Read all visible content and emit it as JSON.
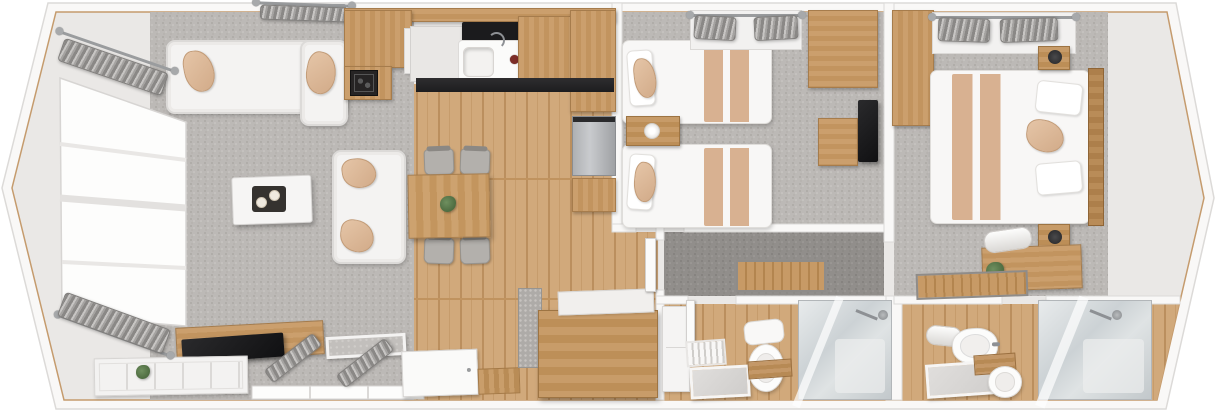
{
  "scene": "lodge-floorplan-3d-top-view",
  "palette": {
    "background": "#ffffff",
    "wall": "#f9f8f7",
    "wall_edge": "#dcdad8",
    "trim_wood": "#c59b6d",
    "floor_vinyl": "#eae8e6",
    "carpet_grey": "#bcb9b6",
    "carpet_dark": "#918e8b",
    "wood_floor": "#d1a97b",
    "wood_furniture": "#c79e6e",
    "sofa_white": "#f4f3f2",
    "cushion_tan": "#d8b191",
    "tv_black": "#1b1b1d",
    "chrome": "#8d9094",
    "glass_shower": "#ccd2d5"
  },
  "rooms": [
    {
      "id": "lounge",
      "name": "lounge-living-area",
      "floor": "grey-carpet"
    },
    {
      "id": "kitchen-diner",
      "name": "kitchen-dining-area",
      "floor": "oak-laminate"
    },
    {
      "id": "twin-bedroom",
      "name": "twin-bedroom",
      "floor": "grey-carpet"
    },
    {
      "id": "hallway",
      "name": "hallway",
      "floor": "dark-carpet"
    },
    {
      "id": "shower-room",
      "name": "family-shower-room",
      "floor": "oak-laminate"
    },
    {
      "id": "master-bedroom",
      "name": "master-bedroom",
      "floor": "grey-carpet"
    },
    {
      "id": "ensuite",
      "name": "ensuite-shower-room",
      "floor": "oak-laminate"
    }
  ],
  "furniture": [
    {
      "n": "kitchen-vent-rack",
      "t": "vent",
      "x": 288,
      "y": 4,
      "w": 58,
      "h": 16
    },
    {
      "n": "lounge-top-curtain-rod",
      "t": "rod",
      "x": 256,
      "y": 3,
      "w": 96,
      "h": 3,
      "r": 2
    },
    {
      "n": "lounge-top-curtain",
      "t": "curtain",
      "x": 260,
      "y": 6,
      "w": 88,
      "h": 15,
      "r": 2
    },
    {
      "n": "corner-sofa-main",
      "t": "sofa",
      "x": 166,
      "y": 40,
      "w": 182,
      "h": 74
    },
    {
      "n": "corner-sofa-chaise",
      "t": "sofa",
      "x": 300,
      "y": 40,
      "w": 48,
      "h": 86
    },
    {
      "n": "sofa-cushion-left",
      "t": "cushion",
      "x": 184,
      "y": 50,
      "w": 30,
      "h": 42,
      "r": -10
    },
    {
      "n": "sofa-cushion-right",
      "t": "cushion",
      "x": 306,
      "y": 52,
      "w": 30,
      "h": 42,
      "r": 12
    },
    {
      "n": "two-seat-sofa",
      "t": "sofa",
      "x": 332,
      "y": 150,
      "w": 74,
      "h": 114
    },
    {
      "n": "two-seat-cushion-top",
      "t": "cushion",
      "x": 342,
      "y": 158,
      "w": 34,
      "h": 30,
      "r": -8
    },
    {
      "n": "two-seat-cushion-bottom",
      "t": "cushion",
      "x": 340,
      "y": 220,
      "w": 34,
      "h": 32,
      "r": 8
    },
    {
      "n": "coffee-table",
      "t": "tablew",
      "x": 232,
      "y": 176,
      "w": 80,
      "h": 48,
      "r": -2
    },
    {
      "n": "coffee-table-tray",
      "t": "tray",
      "x": 252,
      "y": 186,
      "w": 34,
      "h": 26
    },
    {
      "n": "tv-cabinet",
      "t": "wood",
      "x": 176,
      "y": 324,
      "w": 148,
      "h": 34,
      "r": -3
    },
    {
      "n": "television",
      "t": "tv",
      "x": 182,
      "y": 336,
      "w": 102,
      "h": 24,
      "r": -4
    },
    {
      "n": "lounge-sideboard",
      "t": "sideboard",
      "x": 94,
      "y": 357,
      "w": 154,
      "h": 38,
      "r": -1
    },
    {
      "n": "sideboard-plant",
      "t": "plant",
      "x": 136,
      "y": 365,
      "w": 14,
      "h": 14
    },
    {
      "n": "window-ottoman",
      "t": "ottoman",
      "x": 326,
      "y": 335,
      "w": 80,
      "h": 22,
      "r": -3
    },
    {
      "n": "lounge-window-curtain-left",
      "t": "curtain",
      "x": 262,
      "y": 350,
      "w": 62,
      "h": 16,
      "r": -38
    },
    {
      "n": "lounge-window-curtain-right",
      "t": "curtain",
      "x": 334,
      "y": 355,
      "w": 62,
      "h": 16,
      "r": -38
    },
    {
      "n": "bay-curtain-rod-top",
      "t": "rod",
      "x": 56,
      "y": 50,
      "w": 122,
      "h": 3,
      "r": 19
    },
    {
      "n": "bay-curtain-top",
      "t": "curtain",
      "x": 58,
      "y": 55,
      "w": 110,
      "h": 24,
      "r": 19
    },
    {
      "n": "bay-curtain-rod-bottom",
      "t": "rod",
      "x": 54,
      "y": 334,
      "w": 120,
      "h": 3,
      "r": 20
    },
    {
      "n": "bay-curtain-bottom",
      "t": "curtain",
      "x": 58,
      "y": 310,
      "w": 112,
      "h": 26,
      "r": 20
    },
    {
      "n": "kitchen-wall-cabinet-band",
      "t": "wood",
      "x": 344,
      "y": 8,
      "w": 272,
      "h": 14
    },
    {
      "n": "kitchen-corner-cabinet",
      "t": "woodv",
      "x": 344,
      "y": 10,
      "w": 68,
      "h": 58
    },
    {
      "n": "kitchen-open-shelf",
      "t": "shelfw",
      "x": 404,
      "y": 28,
      "w": 30,
      "h": 46
    },
    {
      "n": "kitchen-worktop",
      "t": "worktop",
      "x": 410,
      "y": 26,
      "w": 60,
      "h": 56
    },
    {
      "n": "kitchen-hob",
      "t": "hob",
      "x": 462,
      "y": 22,
      "w": 58,
      "h": 22
    },
    {
      "n": "kitchen-sink",
      "t": "sink",
      "x": 458,
      "y": 40,
      "w": 74,
      "h": 42
    },
    {
      "n": "sink-red-knob",
      "t": "knob",
      "x": 510,
      "y": 55,
      "w": 9,
      "h": 9
    },
    {
      "n": "kitchen-drainer",
      "t": "drainer",
      "x": 528,
      "y": 46,
      "w": 40,
      "h": 16
    },
    {
      "n": "kitchen-cabinet-right",
      "t": "woodv",
      "x": 518,
      "y": 16,
      "w": 56,
      "h": 66
    },
    {
      "n": "kitchen-tall-larder",
      "t": "woodv",
      "x": 570,
      "y": 10,
      "w": 46,
      "h": 102
    },
    {
      "n": "kitchen-lower-units",
      "t": "darkrun",
      "x": 416,
      "y": 78,
      "w": 198,
      "h": 14
    },
    {
      "n": "stove-unit-cabinet",
      "t": "woodv",
      "x": 344,
      "y": 66,
      "w": 48,
      "h": 34
    },
    {
      "n": "log-burner-stove",
      "t": "stove",
      "x": 350,
      "y": 70,
      "w": 28,
      "h": 26
    },
    {
      "n": "fridge-freezer",
      "t": "fridge",
      "x": 572,
      "y": 116,
      "w": 44,
      "h": 60
    },
    {
      "n": "kitchen-base-unit",
      "t": "woodv",
      "x": 572,
      "y": 178,
      "w": 44,
      "h": 34
    },
    {
      "n": "dining-chair-1",
      "t": "chair",
      "x": 424,
      "y": 149,
      "w": 30,
      "h": 26,
      "r": -2
    },
    {
      "n": "dining-chair-2",
      "t": "chair",
      "x": 460,
      "y": 149,
      "w": 30,
      "h": 26,
      "r": 2
    },
    {
      "n": "dining-chair-3",
      "t": "chair",
      "x": 424,
      "y": 238,
      "w": 30,
      "h": 26,
      "r": 2
    },
    {
      "n": "dining-chair-4",
      "t": "chair",
      "x": 460,
      "y": 238,
      "w": 30,
      "h": 26,
      "r": -2
    },
    {
      "n": "dining-table",
      "t": "dtable",
      "x": 408,
      "y": 174,
      "w": 82,
      "h": 64,
      "r": -1
    },
    {
      "n": "dining-centerpiece",
      "t": "plant",
      "x": 440,
      "y": 196,
      "w": 16,
      "h": 16
    },
    {
      "n": "front-door",
      "t": "door",
      "x": 402,
      "y": 350,
      "w": 76,
      "h": 46,
      "r": -2
    },
    {
      "n": "door-mat",
      "t": "mat",
      "x": 478,
      "y": 368,
      "w": 42,
      "h": 26,
      "r": -2
    },
    {
      "n": "bench-side-cushion",
      "t": "benchside",
      "x": 518,
      "y": 288,
      "w": 24,
      "h": 80
    },
    {
      "n": "storage-bench",
      "t": "bench",
      "x": 538,
      "y": 310,
      "w": 120,
      "h": 88
    },
    {
      "n": "storage-bench-lid",
      "t": "shelfw",
      "x": 558,
      "y": 290,
      "w": 96,
      "h": 24,
      "r": -2
    },
    {
      "n": "twin-bed-1",
      "t": "bed",
      "x": 622,
      "y": 40,
      "w": 150,
      "h": 84
    },
    {
      "n": "twin-bed-1-runner",
      "t": "runner",
      "x": 704,
      "y": 44,
      "w": 50,
      "h": 78
    },
    {
      "n": "twin-bed-1-pillow",
      "t": "pillow",
      "x": 628,
      "y": 50,
      "w": 26,
      "h": 56,
      "r": -4
    },
    {
      "n": "twin-bed-1-cushion",
      "t": "cushion",
      "x": 634,
      "y": 58,
      "w": 22,
      "h": 40,
      "r": -6
    },
    {
      "n": "twin-bed-2",
      "t": "bed",
      "x": 622,
      "y": 144,
      "w": 150,
      "h": 84
    },
    {
      "n": "twin-bed-2-runner",
      "t": "runner",
      "x": 704,
      "y": 148,
      "w": 50,
      "h": 78
    },
    {
      "n": "twin-bed-2-pillow",
      "t": "pillow",
      "x": 628,
      "y": 154,
      "w": 26,
      "h": 56,
      "r": 4
    },
    {
      "n": "twin-bed-2-cushion",
      "t": "cushion",
      "x": 634,
      "y": 162,
      "w": 22,
      "h": 40,
      "r": 6
    },
    {
      "n": "twin-nightstand",
      "t": "nightstand",
      "x": 626,
      "y": 116,
      "w": 54,
      "h": 30
    },
    {
      "n": "twin-nightstand-lamp",
      "t": "lamp",
      "x": 644,
      "y": 123,
      "w": 16,
      "h": 16
    },
    {
      "n": "twin-window-pelmet",
      "t": "rail",
      "x": 690,
      "y": 10,
      "w": 112,
      "h": 40
    },
    {
      "n": "twin-curtain-rod",
      "t": "rod",
      "x": 690,
      "y": 14,
      "w": 112,
      "h": 3
    },
    {
      "n": "twin-curtain-left",
      "t": "curtain",
      "x": 694,
      "y": 16,
      "w": 42,
      "h": 24,
      "r": 3
    },
    {
      "n": "twin-curtain-right",
      "t": "curtain",
      "x": 754,
      "y": 16,
      "w": 44,
      "h": 24,
      "r": -3
    },
    {
      "n": "twin-overhead-locker",
      "t": "wood",
      "x": 808,
      "y": 10,
      "w": 70,
      "h": 78
    },
    {
      "n": "twin-dressing-table",
      "t": "wood",
      "x": 818,
      "y": 118,
      "w": 40,
      "h": 48
    },
    {
      "n": "twin-wall-tv",
      "t": "tv",
      "x": 858,
      "y": 100,
      "w": 20,
      "h": 62
    },
    {
      "n": "hallway-runner-rug",
      "t": "rugslat",
      "x": 736,
      "y": 260,
      "w": 90,
      "h": 32
    },
    {
      "n": "hallway-door",
      "t": "doorleaf",
      "x": 645,
      "y": 238,
      "w": 11,
      "h": 54
    },
    {
      "n": "bathroom-tall-cupboard",
      "t": "cabw",
      "x": 662,
      "y": 306,
      "w": 28,
      "h": 86
    },
    {
      "n": "bathroom-door",
      "t": "doorleaf",
      "x": 686,
      "y": 300,
      "w": 9,
      "h": 46
    },
    {
      "n": "bathroom-towel-rail",
      "t": "towelrail",
      "x": 686,
      "y": 340,
      "w": 40,
      "h": 26,
      "r": -4
    },
    {
      "n": "bathroom-vanity-mirror",
      "t": "mirror",
      "x": 690,
      "y": 366,
      "w": 60,
      "h": 32,
      "r": -3
    },
    {
      "n": "bathroom-toilet-cistern",
      "t": "cistern",
      "x": 744,
      "y": 320,
      "w": 40,
      "h": 24,
      "r": -6
    },
    {
      "n": "bathroom-toilet",
      "t": "toilet",
      "x": 748,
      "y": 344,
      "w": 36,
      "h": 48
    },
    {
      "n": "bathroom-caddy",
      "t": "caddy",
      "x": 748,
      "y": 360,
      "w": 44,
      "h": 18,
      "r": -4
    },
    {
      "n": "bathroom-shower",
      "t": "shower",
      "x": 798,
      "y": 300,
      "w": 94,
      "h": 100
    },
    {
      "n": "bathroom-shower-head",
      "t": "showerarm",
      "x": 856,
      "y": 302,
      "w": 32,
      "h": 18
    },
    {
      "n": "master-vanity-unit",
      "t": "woodv",
      "x": 892,
      "y": 10,
      "w": 42,
      "h": 116
    },
    {
      "n": "master-wardrobe",
      "t": "rail",
      "x": 932,
      "y": 12,
      "w": 144,
      "h": 42
    },
    {
      "n": "master-wardrobe-rail",
      "t": "rod",
      "x": 932,
      "y": 16,
      "w": 144,
      "h": 3
    },
    {
      "n": "master-hanging-clothes-left",
      "t": "curtain",
      "x": 938,
      "y": 18,
      "w": 52,
      "h": 24,
      "r": 2
    },
    {
      "n": "master-hanging-clothes-right",
      "t": "curtain",
      "x": 1000,
      "y": 18,
      "w": 58,
      "h": 24,
      "r": -2
    },
    {
      "n": "master-double-bed",
      "t": "bed",
      "x": 930,
      "y": 70,
      "w": 160,
      "h": 154
    },
    {
      "n": "master-bed-runner",
      "t": "runner",
      "x": 952,
      "y": 74,
      "w": 54,
      "h": 146
    },
    {
      "n": "master-headboard",
      "t": "headboard",
      "x": 1088,
      "y": 68,
      "w": 16,
      "h": 158
    },
    {
      "n": "master-pillow-top",
      "t": "pillow",
      "x": 1036,
      "y": 82,
      "w": 46,
      "h": 32,
      "r": 6
    },
    {
      "n": "master-pillow-bottom",
      "t": "pillow",
      "x": 1036,
      "y": 162,
      "w": 46,
      "h": 32,
      "r": -5
    },
    {
      "n": "master-scatter-cushion",
      "t": "cushion",
      "x": 1026,
      "y": 120,
      "w": 38,
      "h": 32,
      "r": 8
    },
    {
      "n": "master-nightstand-top",
      "t": "nightstand",
      "x": 1038,
      "y": 46,
      "w": 32,
      "h": 24
    },
    {
      "n": "master-lamp-top",
      "t": "lampdark",
      "x": 1048,
      "y": 50,
      "w": 14,
      "h": 14
    },
    {
      "n": "master-nightstand-bottom",
      "t": "nightstand",
      "x": 1038,
      "y": 224,
      "w": 32,
      "h": 26
    },
    {
      "n": "master-lamp-bottom",
      "t": "lampdark",
      "x": 1048,
      "y": 230,
      "w": 14,
      "h": 14
    },
    {
      "n": "master-dresser",
      "t": "wood",
      "x": 982,
      "y": 246,
      "w": 100,
      "h": 44,
      "r": -2
    },
    {
      "n": "master-towel-roll",
      "t": "towelroll",
      "x": 984,
      "y": 229,
      "w": 48,
      "h": 22,
      "r": -8
    },
    {
      "n": "master-dresser-plant",
      "t": "plant",
      "x": 986,
      "y": 262,
      "w": 18,
      "h": 18
    },
    {
      "n": "master-runner-rug",
      "t": "rugslat",
      "x": 916,
      "y": 272,
      "w": 112,
      "h": 26,
      "r": -2
    },
    {
      "n": "ensuite-door",
      "t": "doorleaf",
      "x": 1040,
      "y": 300,
      "w": 8,
      "h": 44
    },
    {
      "n": "ensuite-towel-roll",
      "t": "towelroll",
      "x": 926,
      "y": 326,
      "w": 36,
      "h": 20,
      "r": 6
    },
    {
      "n": "ensuite-basin",
      "t": "basin",
      "x": 952,
      "y": 328,
      "w": 46,
      "h": 36,
      "r": -2
    },
    {
      "n": "ensuite-mirror",
      "t": "mirror",
      "x": 926,
      "y": 362,
      "w": 82,
      "h": 34,
      "r": -4
    },
    {
      "n": "ensuite-caddy",
      "t": "caddy",
      "x": 974,
      "y": 354,
      "w": 42,
      "h": 20,
      "r": -4
    },
    {
      "n": "ensuite-toilet",
      "t": "toilet",
      "x": 988,
      "y": 366,
      "w": 34,
      "h": 32
    },
    {
      "n": "ensuite-shower",
      "t": "shower",
      "x": 1038,
      "y": 300,
      "w": 114,
      "h": 100
    },
    {
      "n": "ensuite-shower-head",
      "t": "showerarm",
      "x": 1090,
      "y": 302,
      "w": 32,
      "h": 18
    }
  ]
}
